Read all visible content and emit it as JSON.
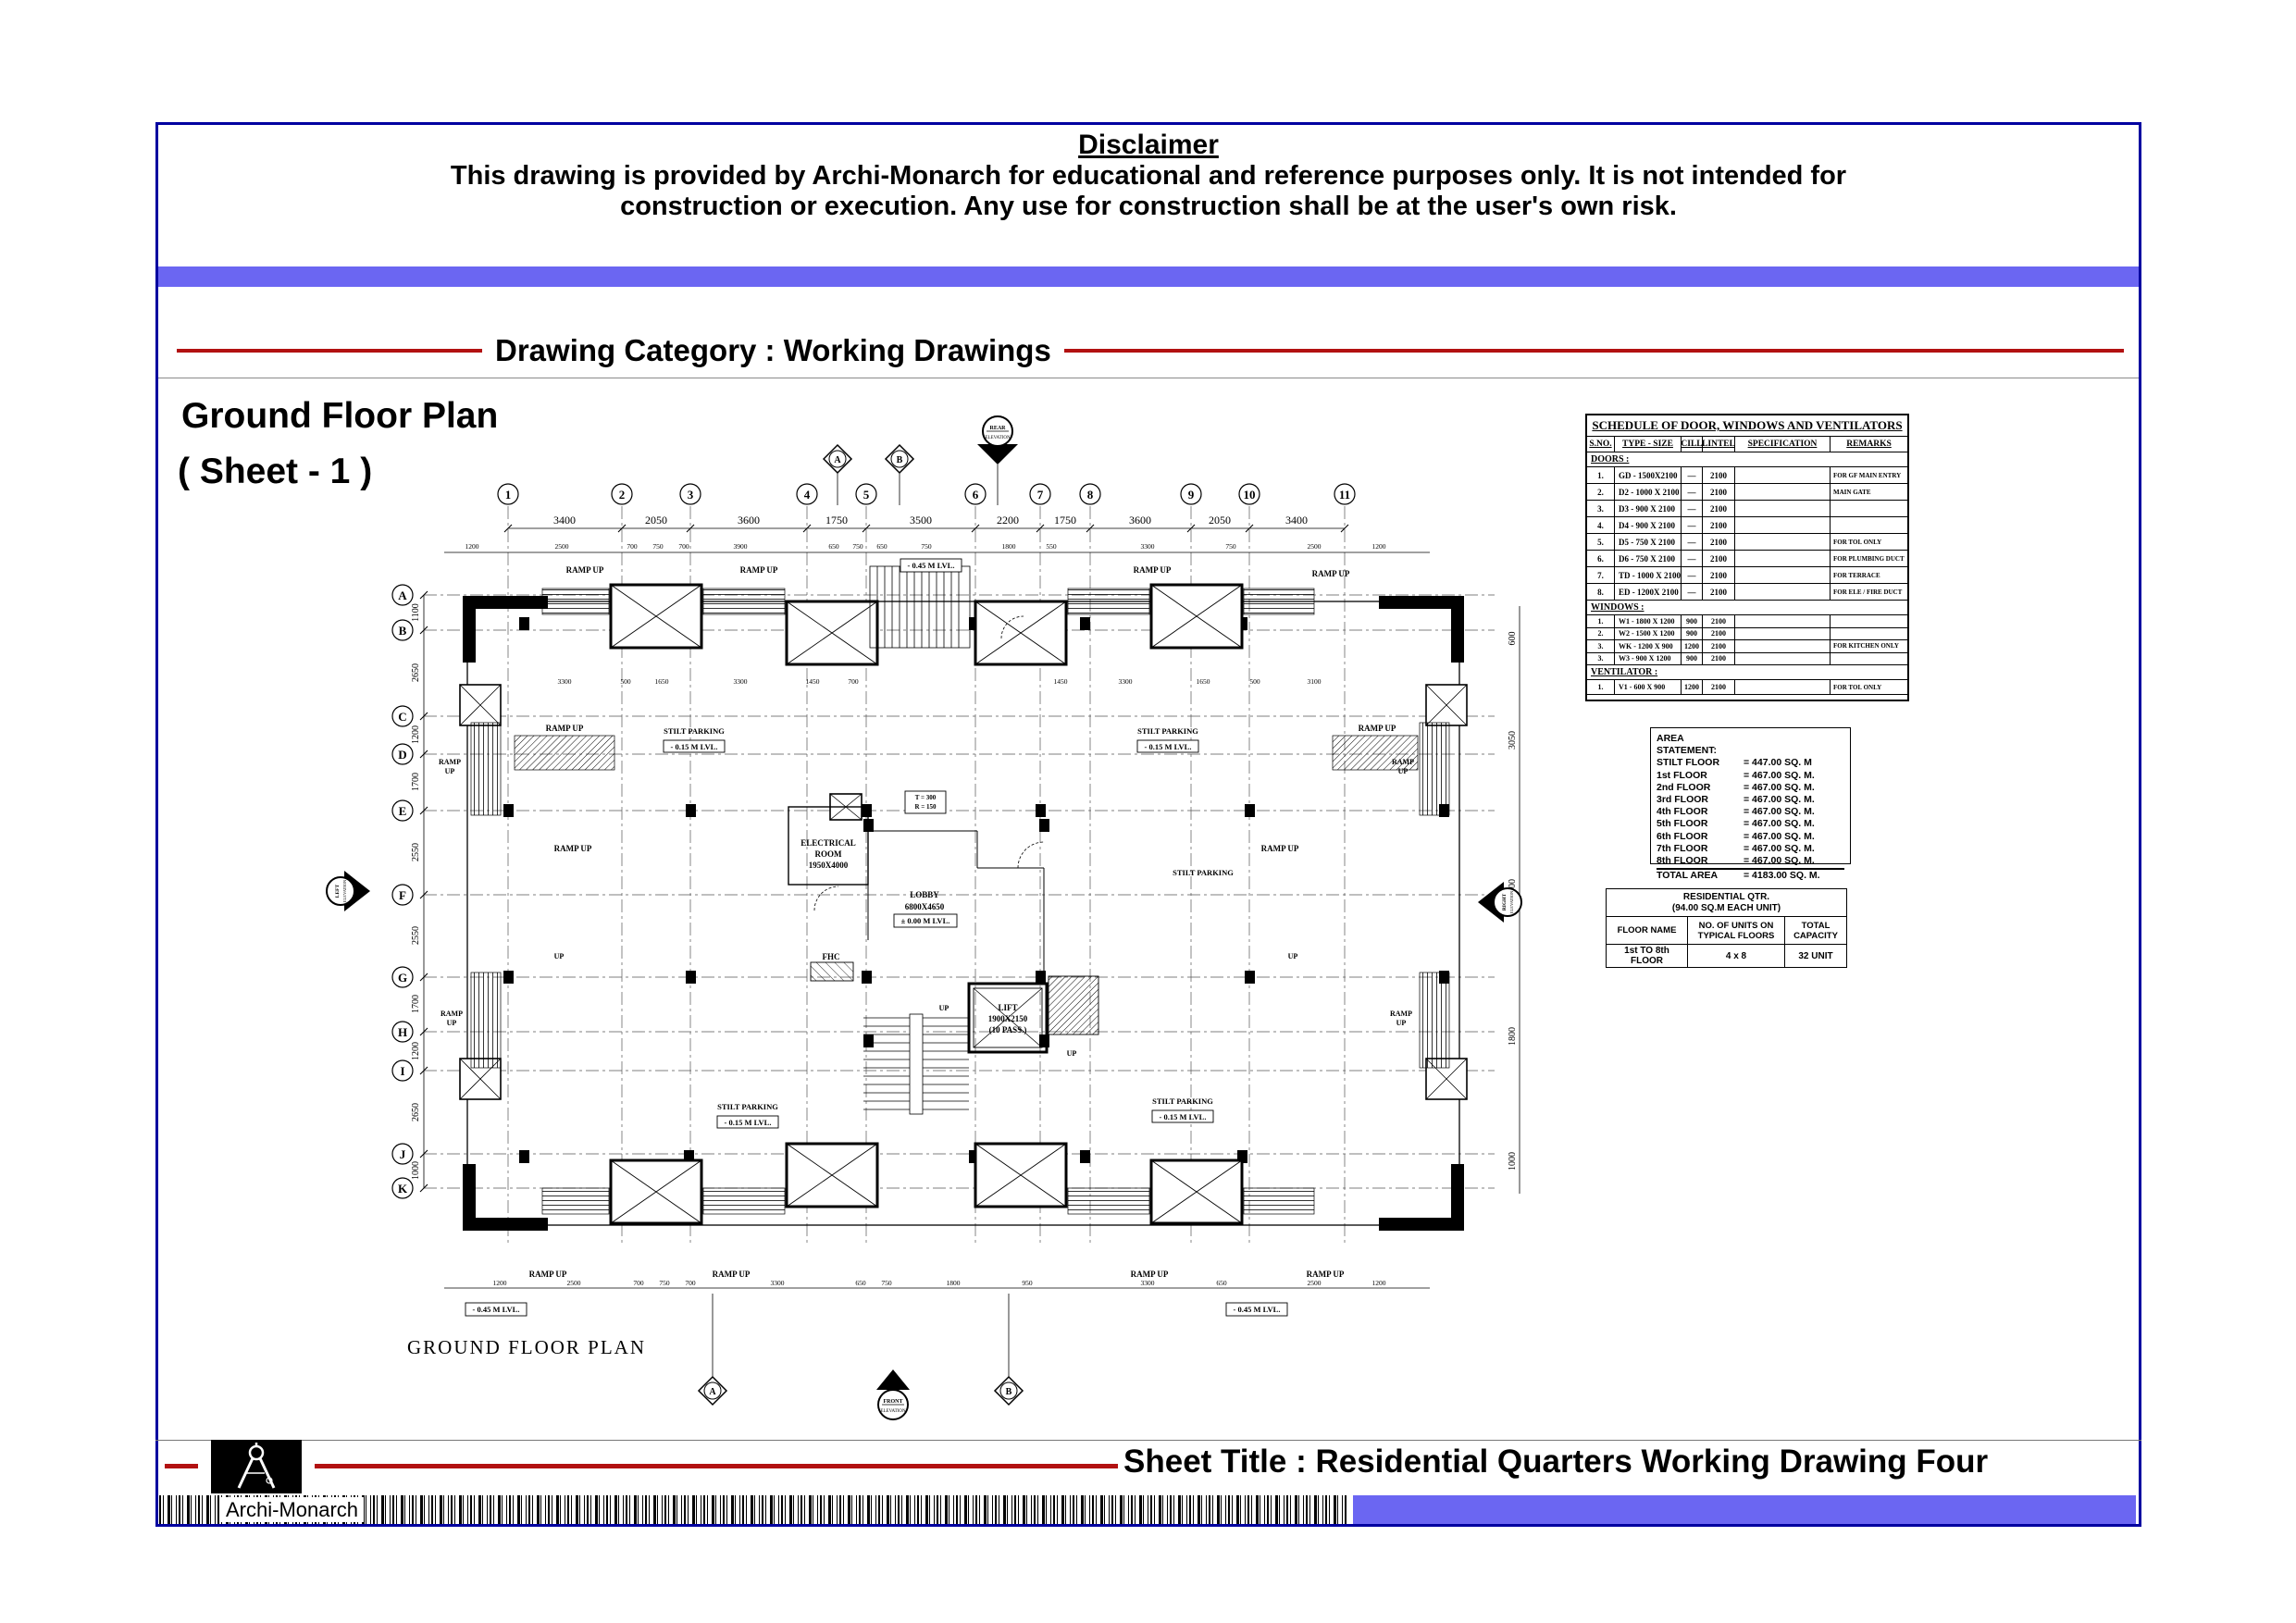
{
  "disclaimer": {
    "title": "Disclaimer",
    "line1": "This drawing is provided by Archi-Monarch for educational and reference purposes only. It is not intended for",
    "line2": "construction or execution. Any use for construction shall be at the user's own risk."
  },
  "category": {
    "label": "Drawing Category : Working Drawings"
  },
  "plan_heading": {
    "line1": "Ground Floor Plan",
    "line2": "( Sheet - 1 )"
  },
  "plan": {
    "caption": "GROUND FLOOR PLAN",
    "grid_cols": [
      "1",
      "2",
      "3",
      "4",
      "5",
      "6",
      "7",
      "8",
      "9",
      "10",
      "11"
    ],
    "grid_rows": [
      "A",
      "B",
      "C",
      "D",
      "E",
      "F",
      "G",
      "H",
      "I",
      "J",
      "K"
    ],
    "top_dims": [
      "3400",
      "2050",
      "3600",
      "1750",
      "3500",
      "2200",
      "1750",
      "3600",
      "2050",
      "3400"
    ],
    "left_dims": [
      "1100",
      "2650",
      "1200",
      "1700",
      "2550",
      "2550",
      "1700",
      "1200",
      "2650",
      "1000"
    ],
    "right_dims": [
      "600",
      "3050",
      "2400",
      "1800",
      "1000"
    ],
    "sub_dims": [
      "1200",
      "2500",
      "700",
      "750",
      "700",
      "3900",
      "650",
      "750",
      "650",
      "750",
      "1800",
      "550",
      "3300",
      "750",
      "2500",
      "1200"
    ],
    "bottom_dims": [
      "1200",
      "2500",
      "700",
      "750",
      "700",
      "3300",
      "650",
      "750",
      "1800",
      "950",
      "3300",
      "650",
      "2500",
      "1200"
    ],
    "inner_dims": [
      "3300",
      "500",
      "1650",
      "3300",
      "1450",
      "700",
      "1450",
      "3300",
      "1650",
      "500",
      "3100"
    ],
    "labels": {
      "ramp_up": "RAMP UP",
      "ramp": "RAMP",
      "up": "UP",
      "stilt_parking": "STILT PARKING",
      "lvl_015": "- 0.15 M LVL.",
      "lvl_000": "± 0.00 M LVL.",
      "lvl_045": "- 0.45 M LVL.",
      "lobby": "LOBBY",
      "lobby_size": "6800X4650",
      "lift": "LIFT",
      "lift_size": "1900X2150",
      "lift_pass": "(10 PASS.)",
      "electrical1": "ELECTRICAL",
      "electrical2": "ROOM",
      "electrical_size": "1950X4000",
      "fhc": "FHC",
      "t_val": "T = 300",
      "r_val": "R = 150",
      "rear": "REAR",
      "front": "FRONT",
      "left": "LEFT",
      "right": "RIGHT",
      "elevation": "ELEVATION",
      "section_a": "A",
      "section_b": "B"
    }
  },
  "schedule": {
    "title": "SCHEDULE OF DOOR, WINDOWS AND VENTILATORS",
    "headers": [
      "S.NO.",
      "TYPE - SIZE",
      "CILL",
      "LINTEL",
      "SPECIFICATION",
      "REMARKS"
    ],
    "sections": [
      {
        "name": "DOORS :",
        "rows": [
          [
            "1.",
            "GD - 1500X2100",
            "—",
            "2100",
            "",
            "FOR GF MAIN ENTRY"
          ],
          [
            "2.",
            "D2 - 1000 X 2100",
            "—",
            "2100",
            "",
            "MAIN GATE"
          ],
          [
            "3.",
            "D3 - 900 X 2100",
            "—",
            "2100",
            "",
            ""
          ],
          [
            "4.",
            "D4 - 900 X 2100",
            "—",
            "2100",
            "",
            ""
          ],
          [
            "5.",
            "D5 - 750 X 2100",
            "—",
            "2100",
            "",
            "FOR TOI. ONLY"
          ],
          [
            "6.",
            "D6 - 750 X 2100",
            "—",
            "2100",
            "",
            "FOR PLUMBING DUCT"
          ],
          [
            "7.",
            "TD - 1000 X 2100",
            "—",
            "2100",
            "",
            "FOR TERRACE"
          ],
          [
            "8.",
            "ED - 1200X 2100",
            "—",
            "2100",
            "",
            "FOR ELE / FIRE DUCT"
          ]
        ]
      },
      {
        "name": "WINDOWS :",
        "rows": [
          [
            "1.",
            "W1 - 1800 X 1200",
            "900",
            "2100",
            "",
            ""
          ],
          [
            "2.",
            "W2 - 1500 X 1200",
            "900",
            "2100",
            "",
            ""
          ],
          [
            "3.",
            "WK - 1200 X 900",
            "1200",
            "2100",
            "",
            "FOR KITCHEN ONLY"
          ],
          [
            "3.",
            "W3 - 900 X 1200",
            "900",
            "2100",
            "",
            ""
          ]
        ]
      },
      {
        "name": "VENTILATOR :",
        "rows": [
          [
            "1.",
            "V1 - 600 X 900",
            "1200",
            "2100",
            "",
            "FOR TOI. ONLY"
          ]
        ]
      }
    ]
  },
  "area_statement": {
    "title": "AREA STATEMENT:",
    "rows": [
      [
        "STILT FLOOR",
        "= 447.00 SQ. M"
      ],
      [
        "1st FLOOR",
        "= 467.00 SQ. M."
      ],
      [
        "2nd FLOOR",
        "= 467.00 SQ. M."
      ],
      [
        "3rd FLOOR",
        "= 467.00 SQ. M."
      ],
      [
        "4th FLOOR",
        "= 467.00 SQ. M."
      ],
      [
        "5th FLOOR",
        "= 467.00 SQ. M."
      ],
      [
        "6th FLOOR",
        "= 467.00 SQ. M."
      ],
      [
        "7th FLOOR",
        "= 467.00 SQ. M."
      ],
      [
        "8th FLOOR",
        "= 467.00 SQ. M."
      ]
    ],
    "total": [
      "TOTAL AREA",
      "= 4183.00 SQ. M."
    ]
  },
  "residential": {
    "title1": "RESIDENTIAL QTR.",
    "title2": "(94.00 SQ.M EACH UNIT)",
    "headers": [
      "FLOOR NAME",
      "NO. OF UNITS ON TYPICAL FLOORS",
      "TOTAL CAPACITY"
    ],
    "row": [
      "1st TO 8th FLOOR",
      "4 x 8",
      "32 UNIT"
    ]
  },
  "footer": {
    "sheet_title": "Sheet Title : Residential Quarters Working Drawing Four",
    "brand": "Archi-Monarch"
  },
  "colors": {
    "accent_blue": "#6b66f2",
    "border_navy": "#0000a0",
    "line_red": "#b21111"
  }
}
